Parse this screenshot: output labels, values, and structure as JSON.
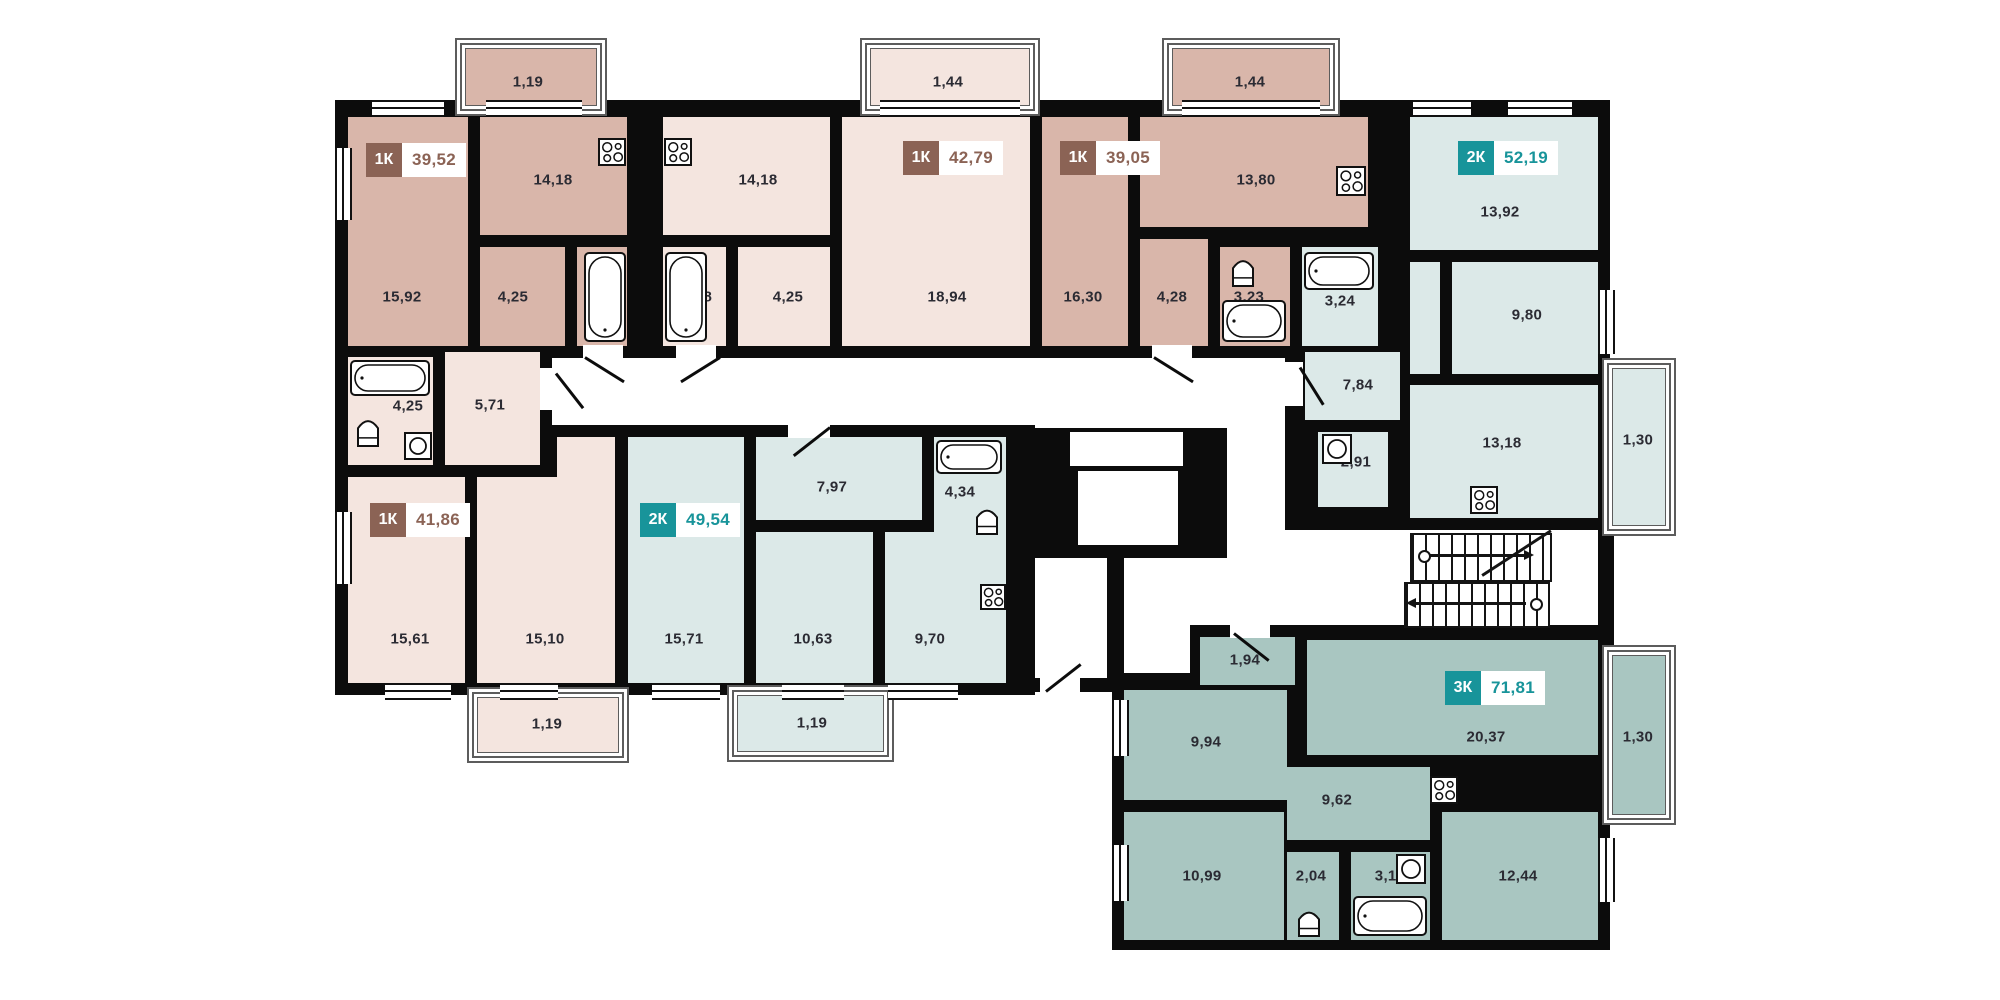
{
  "plan_name": "Residential building floor plan",
  "colors": {
    "wall": "#0c0c0c",
    "apartment_1k_dark": "#d9b6aa",
    "apartment_1k_light": "#f4e5df",
    "apartment_2k": "#dce9e8",
    "apartment_3k": "#a9c6c1",
    "badge_1k": "#8b6355",
    "badge_2k_3k": "#18949a",
    "label_text": "#2b2b33"
  },
  "apartments": [
    {
      "type": "1К",
      "area": "39,52",
      "rooms": [
        "15,92",
        "14,18",
        "4,25",
        "3,98"
      ],
      "balcony": "1,19"
    },
    {
      "type": "1К",
      "area": "42,79",
      "rooms": [
        "14,18",
        "18,94",
        "4,25",
        "3,98"
      ],
      "balcony": "1,44"
    },
    {
      "type": "1К",
      "area": "39,05",
      "rooms": [
        "16,30",
        "13,80",
        "4,28",
        "3,23"
      ],
      "balcony": "1,44"
    },
    {
      "type": "2К",
      "area": "52,19",
      "rooms": [
        "13,92",
        "9,80",
        "",
        "3,24",
        "7,84",
        "2,91",
        "13,18"
      ],
      "balcony": "1,30"
    },
    {
      "type": "1К",
      "area": "41,86",
      "rooms": [
        "4,25",
        "5,71",
        "15,61",
        "15,10",
        ""
      ],
      "balcony": "1,19"
    },
    {
      "type": "2К",
      "area": "49,54",
      "rooms": [
        "15,71",
        "7,97",
        "4,34",
        "10,63",
        "9,70"
      ],
      "balcony": "1,19"
    },
    {
      "type": "3К",
      "area": "71,81",
      "rooms": [
        "20,37",
        "1,94",
        "9,94",
        "10,99",
        "9,62",
        "2,04",
        "3,17",
        "12,44"
      ],
      "balcony": "1,30"
    }
  ]
}
